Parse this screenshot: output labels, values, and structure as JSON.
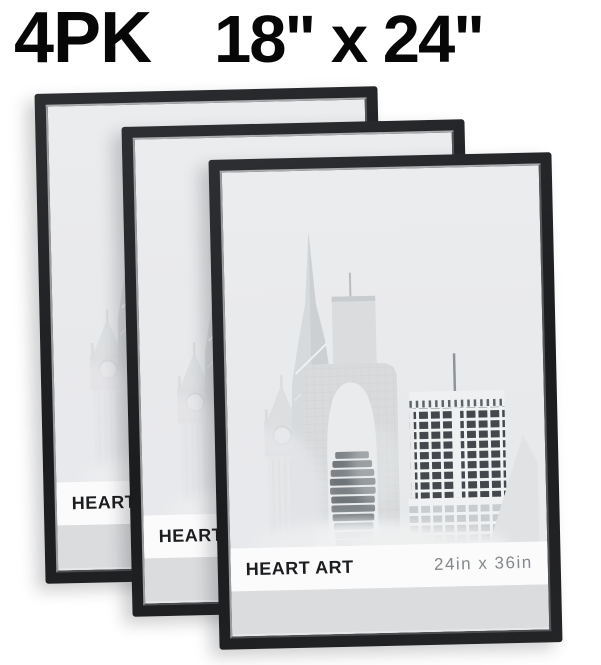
{
  "header": {
    "pack_label": "4PK",
    "size_label": "18\" x 24\""
  },
  "frames": [
    {
      "name": "back",
      "brand": "HEART ART",
      "print_size": "24in x 36in"
    },
    {
      "name": "middle",
      "brand": "HEART ART",
      "print_size": "24in x 36in"
    },
    {
      "name": "front",
      "brand": "HEART ART",
      "print_size": "24in x 36in"
    }
  ],
  "artwork": {
    "name": "misty-city-skyline-artwork"
  },
  "colors": {
    "header_text": "#070707",
    "frame_black": "#1b1c1e",
    "poster_background": "#e9eaec",
    "label_band_background": "#fbfbfc",
    "brand_text": "#1c1d1f",
    "print_size_text": "#85888b",
    "bottom_strip": "#dadcde",
    "dark_building_windows": "#44484c"
  }
}
